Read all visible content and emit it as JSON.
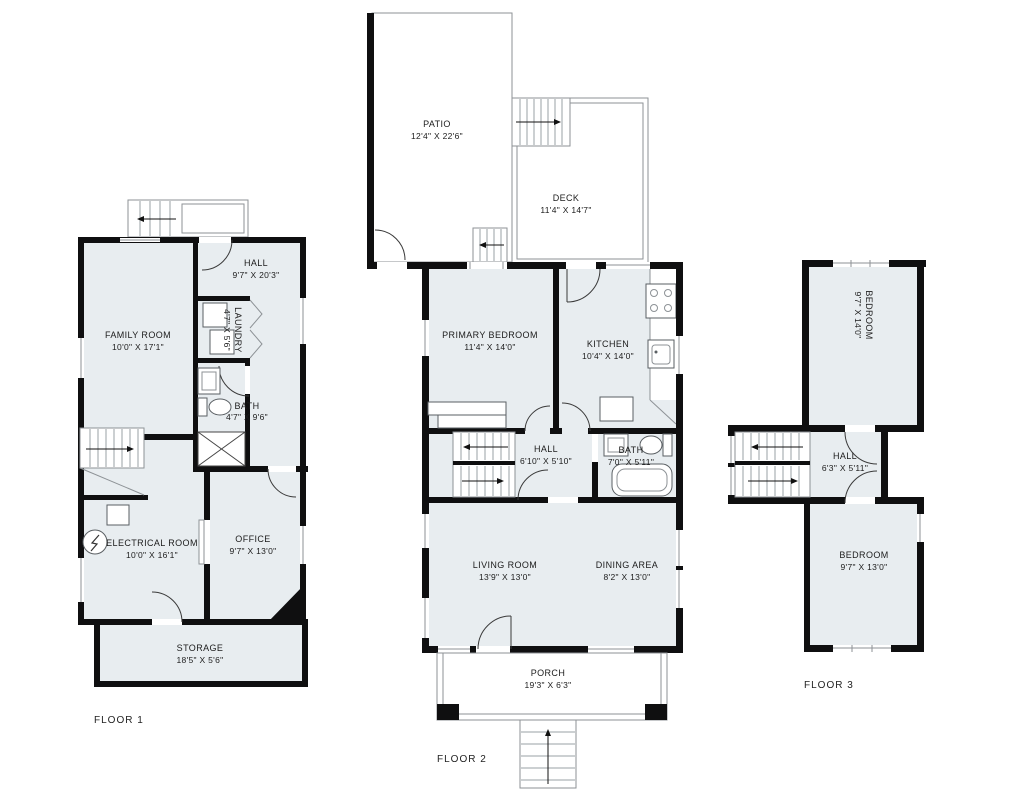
{
  "colors": {
    "room_fill": "#e8edf0",
    "wall": "#0f0f10",
    "outline": "#8d9296",
    "text": "#1c1c1c"
  },
  "floors": [
    {
      "label": "FLOOR 1",
      "rooms": [
        {
          "name": "FAMILY ROOM",
          "dims": "10'0\" X 17'1\""
        },
        {
          "name": "HALL",
          "dims": "9'7\" X 20'3\""
        },
        {
          "name": "LAUNDRY",
          "dims": "4'7\" X 5'6\""
        },
        {
          "name": "BATH",
          "dims": "4'7\" X 9'6\""
        },
        {
          "name": "ELECTRICAL ROOM",
          "dims": "10'0\" X 16'1\""
        },
        {
          "name": "OFFICE",
          "dims": "9'7\" X 13'0\""
        },
        {
          "name": "STORAGE",
          "dims": "18'5\" X 5'6\""
        }
      ]
    },
    {
      "label": "FLOOR 2",
      "rooms": [
        {
          "name": "PATIO",
          "dims": "12'4\" X 22'6\""
        },
        {
          "name": "DECK",
          "dims": "11'4\" X 14'7\""
        },
        {
          "name": "PRIMARY BEDROOM",
          "dims": "11'4\" X 14'0\""
        },
        {
          "name": "KITCHEN",
          "dims": "10'4\" X 14'0\""
        },
        {
          "name": "HALL",
          "dims": "6'10\" X 5'10\""
        },
        {
          "name": "BATH",
          "dims": "7'0\" X 5'11\""
        },
        {
          "name": "LIVING ROOM",
          "dims": "13'9\" X 13'0\""
        },
        {
          "name": "DINING AREA",
          "dims": "8'2\" X 13'0\""
        },
        {
          "name": "PORCH",
          "dims": "19'3\" X 6'3\""
        }
      ]
    },
    {
      "label": "FLOOR 3",
      "rooms": [
        {
          "name": "BEDROOM",
          "dims": "9'7\" X 14'0\""
        },
        {
          "name": "HALL",
          "dims": "6'3\" X 5'11\""
        },
        {
          "name": "BEDROOM",
          "dims": "9'7\" X 13'0\""
        }
      ]
    }
  ]
}
